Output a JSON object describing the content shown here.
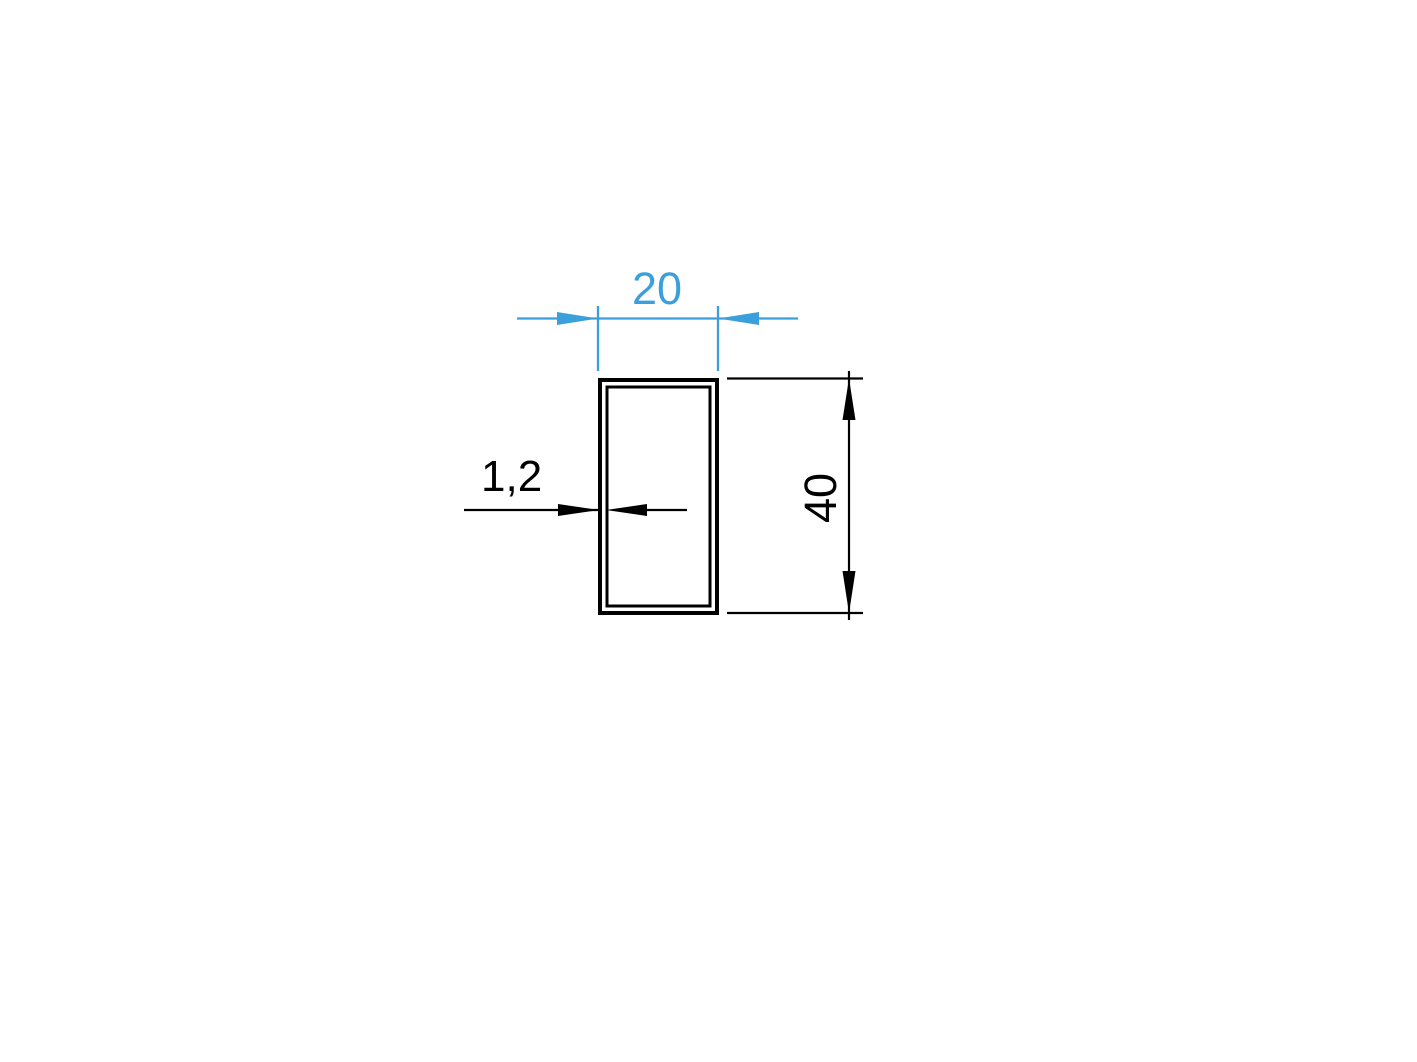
{
  "colors": {
    "background": "#ffffff",
    "line": "#000000",
    "accent": "#3A9FDA"
  },
  "drawing": {
    "dimensions": {
      "width": "20",
      "height": "40",
      "wall_thickness": "1,2"
    }
  }
}
